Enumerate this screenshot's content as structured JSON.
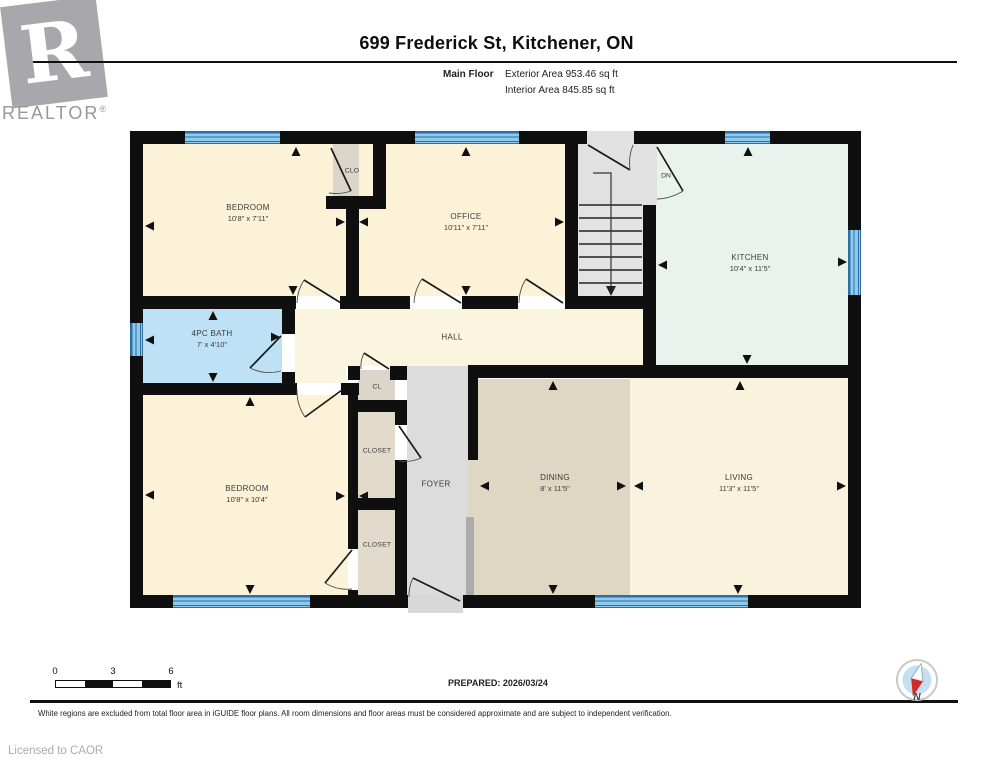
{
  "header": {
    "logo_r": "R",
    "logo_text": "REALTOR",
    "logo_reg": "®",
    "title": "699 Frederick St, Kitchener, ON",
    "floor_label": "Main Floor",
    "exterior_area": "Exterior Area 953.46 sq ft",
    "interior_area": "Interior Area 845.85 sq ft"
  },
  "footer": {
    "scale": {
      "ticks": [
        "0",
        "3",
        "6"
      ],
      "unit": "ft"
    },
    "prepared": "PREPARED: 2026/03/24",
    "compass_label": "N",
    "disclaimer": "White regions are excluded from total floor area in iGUIDE floor plans. All room dimensions and floor areas must be considered approximate and are subject to independent verification.",
    "license": "Licensed to CAOR"
  },
  "colors": {
    "wall": "#0F0F0F",
    "cream": "#FBF2D7",
    "kitchen": "#E9F2EC",
    "bath": "#BFE1F6",
    "dining": "#E0D6C4",
    "closet": "#E2DACB",
    "gray": "#DCDCDC",
    "window_blue": "#8FC9EC",
    "compass_red": "#CF2B27"
  },
  "plan": {
    "rooms": [
      {
        "id": "bedroom-1",
        "name": "BEDROOM",
        "dims": "10'8\" x 7'11\"",
        "x": 143,
        "y": 144,
        "w": 203,
        "h": 152,
        "c": "#FBF2D7",
        "lx": 248,
        "ly": 213
      },
      {
        "id": "clo",
        "name": "CLO",
        "x": 333,
        "y": 144,
        "w": 40,
        "h": 52,
        "c": "#DCD5C9",
        "lx": 352,
        "ly": 171,
        "s": 1
      },
      {
        "id": "office",
        "name": "OFFICE",
        "dims": "10'11\" x 7'11\"",
        "x": 359,
        "y": 144,
        "w": 206,
        "h": 152,
        "c": "#FBF2D7",
        "lx": 466,
        "ly": 222
      },
      {
        "id": "kitchen",
        "name": "KITCHEN",
        "dims": "10'4\" x 11'5\"",
        "x": 656,
        "y": 144,
        "w": 192,
        "h": 221,
        "c": "#E9F2EC",
        "lx": 750,
        "ly": 263
      },
      {
        "id": "bath",
        "name": "4PC BATH",
        "dims": "7' x 4'10\"",
        "x": 143,
        "y": 309,
        "w": 139,
        "h": 74,
        "c": "#BFE1F6",
        "lx": 212,
        "ly": 339
      },
      {
        "id": "hall",
        "name": "HALL",
        "x": 295,
        "y": 309,
        "w": 348,
        "h": 57,
        "c": "#FBF4DE",
        "lx": 452,
        "ly": 337
      },
      {
        "id": "hall-nook",
        "x": 295,
        "y": 366,
        "w": 51,
        "h": 17,
        "c": "#FBF4DE"
      },
      {
        "id": "bedroom-2",
        "name": "BEDROOM",
        "dims": "10'8\" x 10'4\"",
        "x": 143,
        "y": 395,
        "w": 205,
        "h": 200,
        "c": "#FBF2D7",
        "lx": 247,
        "ly": 494
      },
      {
        "id": "cl",
        "name": "CL",
        "x": 358,
        "y": 370,
        "w": 37,
        "h": 30,
        "c": "#DCD5C9",
        "lx": 377,
        "ly": 387,
        "s": 1
      },
      {
        "id": "closet-upper",
        "name": "CLOSET",
        "x": 358,
        "y": 412,
        "w": 37,
        "h": 86,
        "c": "#E2DACB",
        "lx": 377,
        "ly": 451,
        "s": 1
      },
      {
        "id": "closet-lower",
        "name": "CLOSET",
        "x": 358,
        "y": 510,
        "w": 37,
        "h": 85,
        "c": "#E2DACB",
        "lx": 377,
        "ly": 545,
        "s": 1
      },
      {
        "id": "foyer",
        "name": "FOYER",
        "x": 407,
        "y": 366,
        "w": 61,
        "h": 229,
        "c": "#DCDCDC",
        "lx": 436,
        "ly": 484
      },
      {
        "id": "dining",
        "name": "DINING",
        "dims": "8' x 11'5\"",
        "x": 468,
        "y": 379,
        "w": 162,
        "h": 216,
        "c": "#E0D6C4",
        "lx": 555,
        "ly": 483
      },
      {
        "id": "living",
        "name": "LIVING",
        "dims": "11'3\" x 11'5\"",
        "x": 630,
        "y": 378,
        "w": 218,
        "h": 217,
        "c": "#F9F2DC",
        "lx": 739,
        "ly": 483
      }
    ],
    "walls": [
      [
        130,
        131,
        731,
        13
      ],
      [
        130,
        595,
        278,
        13
      ],
      [
        463,
        595,
        398,
        13
      ],
      [
        130,
        131,
        13,
        477
      ],
      [
        848,
        131,
        13,
        477
      ],
      [
        346,
        196,
        13,
        113
      ],
      [
        326,
        196,
        60,
        13
      ],
      [
        373,
        144,
        13,
        65
      ],
      [
        565,
        144,
        13,
        165
      ],
      [
        565,
        296,
        91,
        13
      ],
      [
        643,
        205,
        13,
        173
      ],
      [
        130,
        296,
        166,
        13
      ],
      [
        340,
        296,
        19,
        13
      ],
      [
        359,
        296,
        51,
        13
      ],
      [
        462,
        296,
        56,
        13
      ],
      [
        282,
        296,
        13,
        38
      ],
      [
        282,
        372,
        13,
        23
      ],
      [
        130,
        383,
        167,
        12
      ],
      [
        341,
        383,
        18,
        12
      ],
      [
        348,
        383,
        10,
        166
      ],
      [
        348,
        590,
        10,
        18
      ],
      [
        348,
        366,
        12,
        14
      ],
      [
        390,
        366,
        17,
        14
      ],
      [
        348,
        400,
        59,
        12
      ],
      [
        348,
        498,
        59,
        12
      ],
      [
        395,
        412,
        12,
        13
      ],
      [
        395,
        460,
        12,
        135
      ],
      [
        468,
        365,
        393,
        13
      ],
      [
        468,
        365,
        10,
        95
      ]
    ],
    "overlays": [
      {
        "x": 578,
        "y": 144,
        "w": 79,
        "h": 61,
        "c": "#E1E1E1"
      },
      {
        "x": 587,
        "y": 131,
        "w": 47,
        "h": 13,
        "c": "#E1E1E1"
      },
      {
        "x": 578,
        "y": 205,
        "w": 65,
        "h": 91,
        "c": "#E3E3E3"
      },
      {
        "x": 408,
        "y": 595,
        "w": 55,
        "h": 18,
        "c": "#D8D8D8"
      },
      {
        "x": 466,
        "y": 517,
        "w": 8,
        "h": 78,
        "c": "#ABABAB"
      }
    ],
    "windows": [
      {
        "x": 185,
        "y": 131,
        "w": 95,
        "h": 13,
        "o": "h"
      },
      {
        "x": 415,
        "y": 131,
        "w": 104,
        "h": 13,
        "o": "h"
      },
      {
        "x": 725,
        "y": 131,
        "w": 45,
        "h": 13,
        "o": "h"
      },
      {
        "x": 130,
        "y": 323,
        "w": 13,
        "h": 33,
        "o": "v"
      },
      {
        "x": 848,
        "y": 230,
        "w": 13,
        "h": 65,
        "o": "v"
      },
      {
        "x": 173,
        "y": 595,
        "w": 137,
        "h": 13,
        "o": "h"
      },
      {
        "x": 595,
        "y": 595,
        "w": 153,
        "h": 13,
        "o": "h"
      }
    ],
    "doors": [
      {
        "line": [
          588,
          145,
          630,
          170
        ],
        "arc": "M630,170 A48,48 0 0 1 633,145"
      },
      {
        "line": [
          657,
          147,
          683,
          191
        ],
        "arc": "M683,191 A52,52 0 0 1 657,199"
      },
      {
        "line": [
          331,
          148,
          351,
          191
        ],
        "arc": "M351,191 A47,47 0 0 1 329,193"
      },
      {
        "line": [
          341,
          303,
          304,
          280
        ],
        "arc": "M304,280 A45,45 0 0 0 297,303"
      },
      {
        "line": [
          461,
          303,
          422,
          279
        ],
        "arc": "M422,279 A46,46 0 0 0 414,303"
      },
      {
        "line": [
          563,
          303,
          526,
          279
        ],
        "arc": "M526,279 A45,45 0 0 0 519,303"
      },
      {
        "line": [
          281,
          336,
          250,
          368
        ],
        "arc": "M250,368 A45,45 0 0 0 281,371"
      },
      {
        "line": [
          342,
          390,
          305,
          417
        ],
        "arc": "M305,417 A46,46 0 0 1 297,390"
      },
      {
        "line": [
          389,
          369,
          364,
          353
        ],
        "arc": "M364,353 A30,30 0 0 0 361,369"
      },
      {
        "line": [
          399,
          426,
          421,
          458
        ],
        "arc": "M421,458 A39,39 0 0 1 399,461"
      },
      {
        "line": [
          352,
          550,
          325,
          583
        ],
        "arc": "M325,583 A43,43 0 0 0 352,589"
      },
      {
        "line": [
          413,
          578,
          460,
          601
        ],
        "arc": "M413,578 A40,40 0 0 0 409,597"
      }
    ],
    "stairs": {
      "x1": 579,
      "x2": 642,
      "steps": [
        205,
        218,
        231,
        244,
        257,
        270,
        283
      ],
      "guide": [
        593,
        173,
        611,
        173,
        611,
        287
      ],
      "head": [
        611,
        296
      ]
    },
    "arrows": [
      {
        "x": 296,
        "y": 147,
        "d": "up"
      },
      {
        "x": 466,
        "y": 147,
        "d": "up"
      },
      {
        "x": 748,
        "y": 147,
        "d": "up"
      },
      {
        "x": 213,
        "y": 311,
        "d": "up"
      },
      {
        "x": 250,
        "y": 397,
        "d": "up"
      },
      {
        "x": 553,
        "y": 381,
        "d": "up"
      },
      {
        "x": 740,
        "y": 381,
        "d": "up"
      },
      {
        "x": 293,
        "y": 295,
        "d": "down"
      },
      {
        "x": 466,
        "y": 295,
        "d": "down"
      },
      {
        "x": 747,
        "y": 364,
        "d": "down"
      },
      {
        "x": 213,
        "y": 382,
        "d": "down"
      },
      {
        "x": 250,
        "y": 594,
        "d": "down"
      },
      {
        "x": 553,
        "y": 594,
        "d": "down"
      },
      {
        "x": 738,
        "y": 594,
        "d": "down"
      },
      {
        "x": 145,
        "y": 226,
        "d": "left"
      },
      {
        "x": 145,
        "y": 340,
        "d": "left"
      },
      {
        "x": 145,
        "y": 495,
        "d": "left"
      },
      {
        "x": 658,
        "y": 265,
        "d": "left"
      },
      {
        "x": 480,
        "y": 486,
        "d": "left"
      },
      {
        "x": 634,
        "y": 486,
        "d": "left"
      },
      {
        "x": 359,
        "y": 222,
        "d": "left"
      },
      {
        "x": 359,
        "y": 496,
        "d": "left"
      },
      {
        "x": 345,
        "y": 222,
        "d": "right"
      },
      {
        "x": 564,
        "y": 222,
        "d": "right"
      },
      {
        "x": 847,
        "y": 262,
        "d": "right"
      },
      {
        "x": 280,
        "y": 337,
        "d": "right"
      },
      {
        "x": 345,
        "y": 496,
        "d": "right"
      },
      {
        "x": 626,
        "y": 486,
        "d": "right"
      },
      {
        "x": 846,
        "y": 486,
        "d": "right"
      }
    ],
    "small_labels": [
      {
        "t": "DN",
        "x": 666,
        "y": 176
      }
    ]
  }
}
